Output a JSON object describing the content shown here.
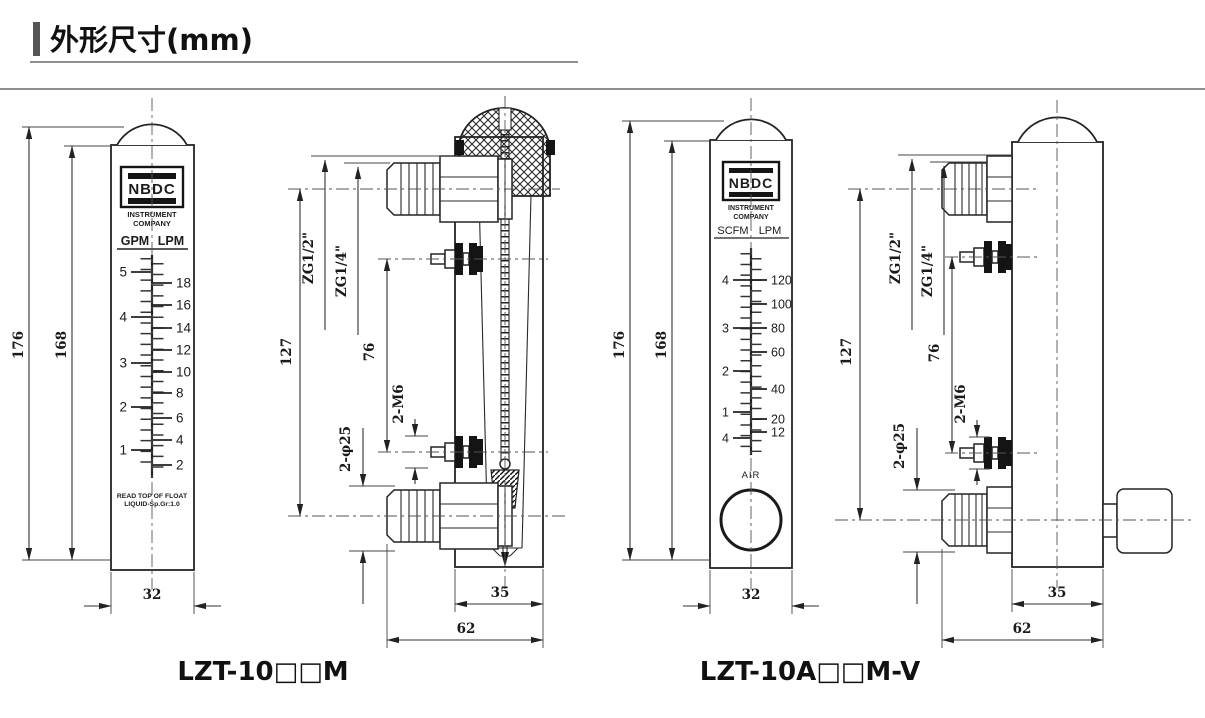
{
  "title": "外形尺寸(mm)",
  "brand": {
    "name": "NBDC",
    "sub1": "INSTRUMENT",
    "sub2": "COMPANY"
  },
  "front_dims": {
    "height_outer": "176",
    "height_inner": "168",
    "width": "32"
  },
  "side_dims": {
    "length": "127",
    "port_span": "76",
    "mount_thread": "2-M6",
    "mount_dia": "2-φ25",
    "inlet_thread": "ZG1/2\"",
    "aux_thread": "ZG1/4\"",
    "depth": "35",
    "total_depth": "62"
  },
  "meter1": {
    "unit_left": "GPM",
    "unit_right": "LPM",
    "note1": "READ TOP OF FLOAT",
    "note2": "LIQUID-Sp.Gr:1.0",
    "model": "LZT-10□□M"
  },
  "meter2": {
    "unit_left": "SCFM",
    "unit_right": "LPM",
    "medium": "AIR",
    "model": "LZT-10A□□M-V"
  },
  "scales": {
    "meter1": {
      "left": [
        [
          "5",
          272
        ],
        [
          "4",
          317
        ],
        [
          "3",
          363
        ],
        [
          "2",
          407
        ],
        [
          "1",
          450
        ]
      ],
      "right": [
        [
          "18",
          283
        ],
        [
          "16",
          305
        ],
        [
          "14",
          328
        ],
        [
          "12",
          350
        ],
        [
          "10",
          372
        ],
        [
          "8",
          393
        ],
        [
          "6",
          418
        ],
        [
          "4",
          440
        ],
        [
          "2",
          465
        ]
      ]
    },
    "meter2": {
      "left": [
        [
          "4",
          280
        ],
        [
          "3",
          328
        ],
        [
          "2",
          371
        ],
        [
          "1",
          412
        ],
        [
          "4",
          438
        ]
      ],
      "right": [
        [
          "120",
          280
        ],
        [
          "100",
          304
        ],
        [
          "80",
          328
        ],
        [
          "60",
          352
        ],
        [
          "40",
          389
        ],
        [
          "20",
          419
        ],
        [
          "12",
          432
        ]
      ]
    }
  }
}
